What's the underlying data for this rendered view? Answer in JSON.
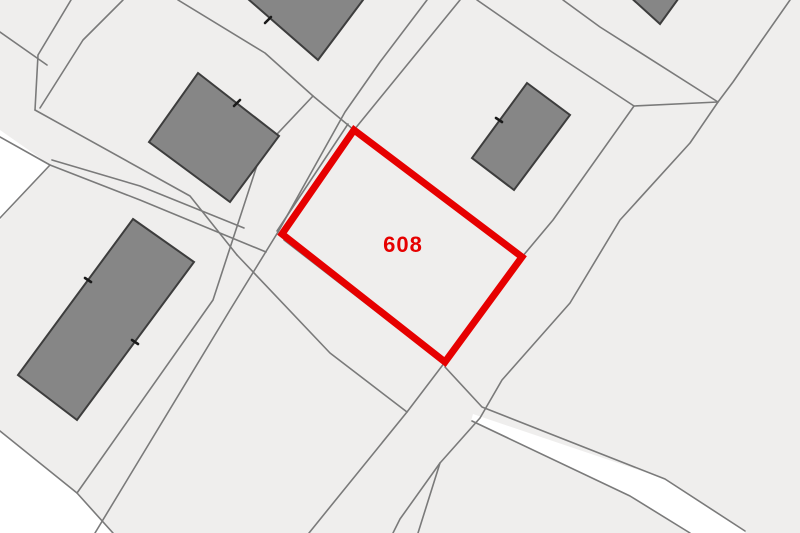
{
  "map": {
    "canvas": {
      "width": 800,
      "height": 533
    },
    "colors": {
      "background": "#efeeed",
      "white_area": "#ffffff",
      "boundary_line": "#7a7a7a",
      "building_fill": "#868686",
      "building_stroke": "#3d3d3d",
      "tick_mark": "#1a1a1a",
      "highlight": "#e60000"
    },
    "parcel": {
      "label": "608",
      "label_pos": [
        403,
        252
      ],
      "label_size": 22,
      "stroke_width": 7,
      "points": [
        [
          354,
          130
        ],
        [
          522,
          257
        ],
        [
          445,
          362
        ],
        [
          282,
          234
        ]
      ]
    },
    "white_areas": [
      {
        "name": "white-area-left",
        "points": [
          [
            0,
            130
          ],
          [
            50,
            165
          ],
          [
            0,
            220
          ]
        ]
      },
      {
        "name": "white-area-bottom-left",
        "points": [
          [
            0,
            431
          ],
          [
            77,
            493
          ],
          [
            113,
            533
          ],
          [
            0,
            533
          ]
        ]
      },
      {
        "name": "white-path-bottom-right",
        "points": [
          [
            473,
            414
          ],
          [
            665,
            479
          ],
          [
            745,
            531
          ],
          [
            745,
            533
          ],
          [
            688,
            533
          ],
          [
            630,
            496
          ],
          [
            471,
            421
          ]
        ]
      }
    ],
    "boundary_lines": [
      [
        [
          71,
          0
        ],
        [
          38,
          55
        ],
        [
          35,
          110
        ]
      ],
      [
        [
          123,
          0
        ],
        [
          83,
          40
        ],
        [
          40,
          108
        ]
      ],
      [
        [
          0,
          32
        ],
        [
          47,
          65
        ]
      ],
      [
        [
          35,
          110
        ],
        [
          190,
          196
        ],
        [
          237,
          255
        ]
      ],
      [
        [
          50,
          165
        ],
        [
          140,
          200
        ],
        [
          266,
          252
        ]
      ],
      [
        [
          52,
          160
        ],
        [
          140,
          186
        ],
        [
          244,
          228
        ]
      ],
      [
        [
          0,
          137
        ],
        [
          50,
          165
        ],
        [
          0,
          218
        ]
      ],
      [
        [
          178,
          0
        ],
        [
          265,
          53
        ],
        [
          313,
          96
        ],
        [
          354,
          130
        ]
      ],
      [
        [
          460,
          0
        ],
        [
          354,
          130
        ]
      ],
      [
        [
          427,
          0
        ],
        [
          380,
          62
        ],
        [
          345,
          112
        ],
        [
          278,
          232
        ],
        [
          230,
          310
        ],
        [
          95,
          533
        ]
      ],
      [
        [
          313,
          96
        ],
        [
          262,
          150
        ],
        [
          213,
          300
        ],
        [
          77,
          493
        ]
      ],
      [
        [
          348,
          124
        ],
        [
          277,
          231
        ]
      ],
      [
        [
          284,
          240
        ],
        [
          443,
          363
        ]
      ],
      [
        [
          237,
          255
        ],
        [
          330,
          353
        ],
        [
          407,
          412
        ]
      ],
      [
        [
          445,
          362
        ],
        [
          407,
          412
        ],
        [
          330,
          507
        ],
        [
          309,
          533
        ]
      ],
      [
        [
          790,
          0
        ],
        [
          762,
          40
        ],
        [
          733,
          82
        ],
        [
          718,
          102
        ],
        [
          690,
          143
        ],
        [
          620,
          220
        ],
        [
          570,
          303
        ],
        [
          502,
          380
        ],
        [
          480,
          418
        ],
        [
          440,
          463
        ],
        [
          400,
          519
        ],
        [
          393,
          533
        ]
      ],
      [
        [
          440,
          463
        ],
        [
          418,
          533
        ]
      ],
      [
        [
          477,
          0
        ],
        [
          552,
          52
        ],
        [
          634,
          106
        ]
      ],
      [
        [
          634,
          106
        ],
        [
          553,
          220
        ],
        [
          522,
          257
        ]
      ],
      [
        [
          563,
          0
        ],
        [
          600,
          27
        ],
        [
          718,
          102
        ]
      ],
      [
        [
          634,
          106
        ],
        [
          718,
          102
        ]
      ],
      [
        [
          0,
          431
        ],
        [
          77,
          493
        ],
        [
          113,
          533
        ]
      ],
      [
        [
          445,
          367
        ],
        [
          482,
          407
        ],
        [
          665,
          479
        ],
        [
          745,
          531
        ]
      ],
      [
        [
          472,
          421
        ],
        [
          630,
          496
        ],
        [
          690,
          533
        ]
      ]
    ],
    "buildings": [
      {
        "name": "building-top-middle",
        "points": [
          [
            240,
            -8
          ],
          [
            318,
            60
          ],
          [
            372,
            -12
          ],
          [
            306,
            -70
          ]
        ],
        "ticks": [
          [
            265,
            23,
            271,
            17
          ]
        ]
      },
      {
        "name": "building-center-left",
        "points": [
          [
            198,
            73
          ],
          [
            279,
            136
          ],
          [
            230,
            202
          ],
          [
            149,
            142
          ]
        ],
        "ticks": [
          [
            234,
            106,
            240,
            100
          ]
        ]
      },
      {
        "name": "building-left-large",
        "points": [
          [
            133,
            219
          ],
          [
            194,
            262
          ],
          [
            77,
            420
          ],
          [
            18,
            375
          ]
        ],
        "ticks": [
          [
            85,
            278,
            91,
            282
          ],
          [
            132,
            340,
            138,
            344
          ]
        ]
      },
      {
        "name": "building-right",
        "points": [
          [
            527,
            83
          ],
          [
            570,
            115
          ],
          [
            514,
            190
          ],
          [
            472,
            158
          ]
        ],
        "ticks": [
          [
            496,
            118,
            502,
            122
          ]
        ]
      },
      {
        "name": "building-top-right",
        "points": [
          [
            617,
            -15
          ],
          [
            681,
            -5
          ],
          [
            660,
            24
          ]
        ],
        "ticks": []
      }
    ]
  }
}
